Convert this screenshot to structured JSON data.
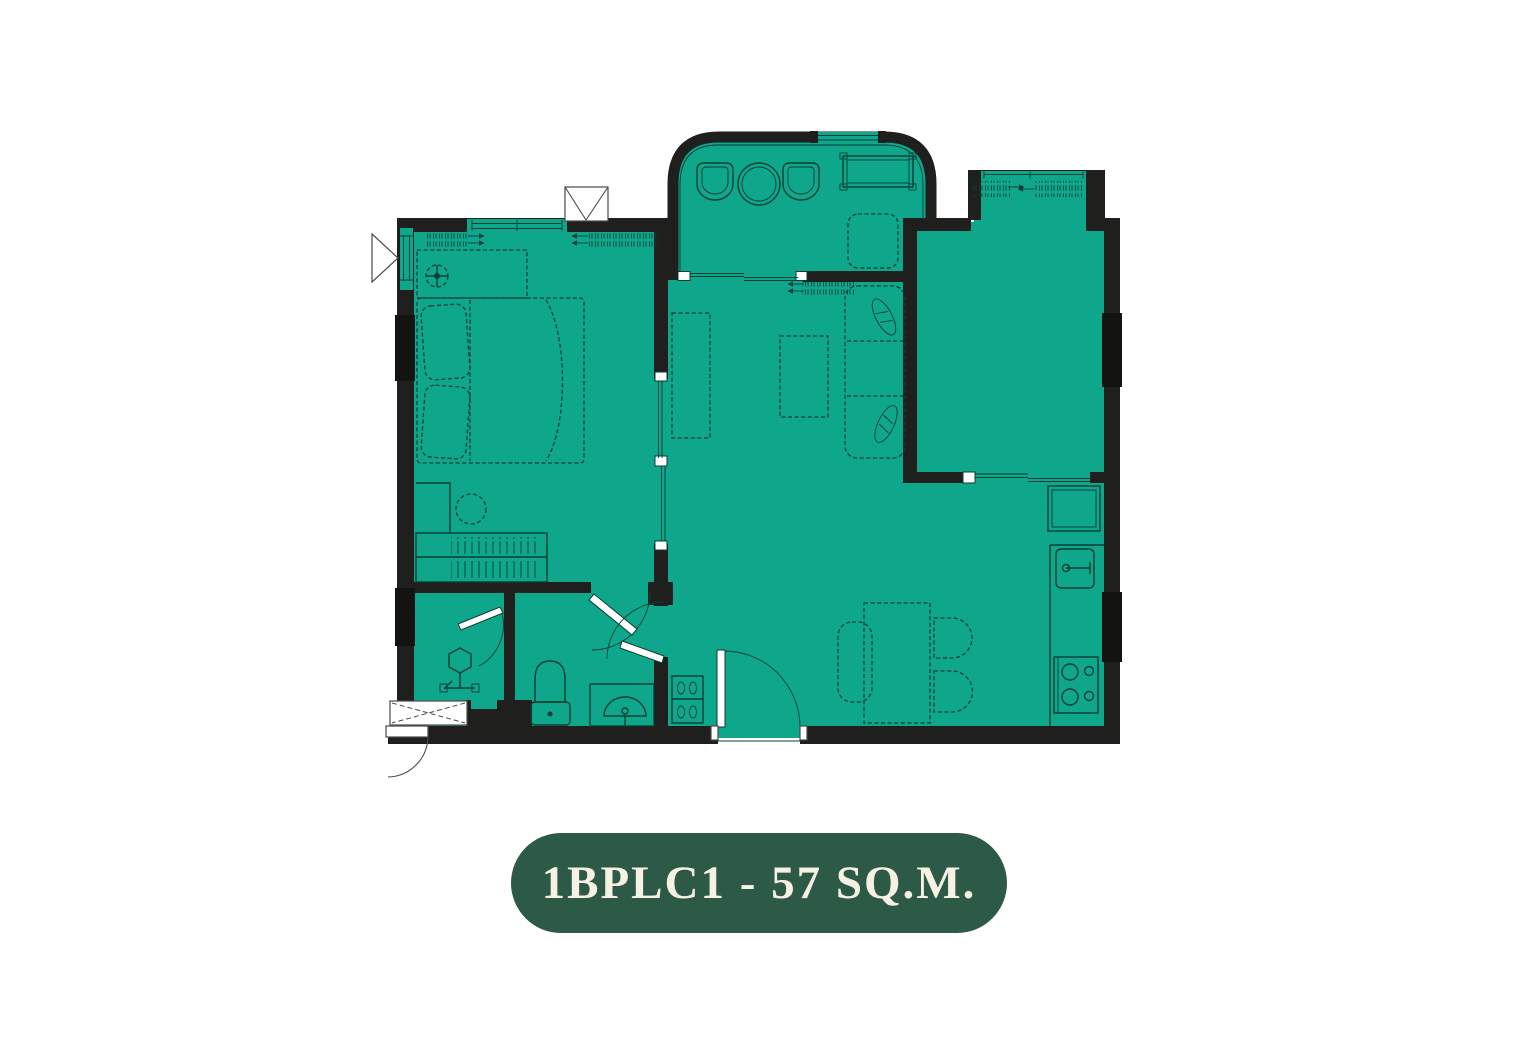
{
  "label": {
    "unit_code": "1BPLC1",
    "area": "57 SQ.M.",
    "text": "1BPLC1 - 57 SQ.M."
  },
  "floorplan": {
    "colors": {
      "floor": "#0EA78B",
      "wall": "#1F1F1D",
      "column": "#131311",
      "line": "#0C3D34",
      "label_bg": "#2D5947",
      "label_text": "#F6F1E2"
    },
    "rooms": [
      "bedroom",
      "bathroom",
      "living-dining",
      "kitchen",
      "balcony",
      "multipurpose-room",
      "entrance-foyer"
    ],
    "furniture_symbols": [
      "bed",
      "pillows",
      "wardrobe-hatch",
      "ceiling-fan",
      "dresser",
      "stool",
      "desk",
      "sofa",
      "sofa-cushions",
      "coffee-table",
      "tv-console",
      "dining-table",
      "dining-bench",
      "dining-chair",
      "refrigerator",
      "kitchen-counter",
      "kitchen-sink",
      "stove",
      "toilet",
      "bathroom-sink",
      "shower",
      "shoe-cabinet",
      "balcony-chair",
      "balcony-table",
      "balcony-bench",
      "entrance-door",
      "sliding-door",
      "window"
    ]
  }
}
